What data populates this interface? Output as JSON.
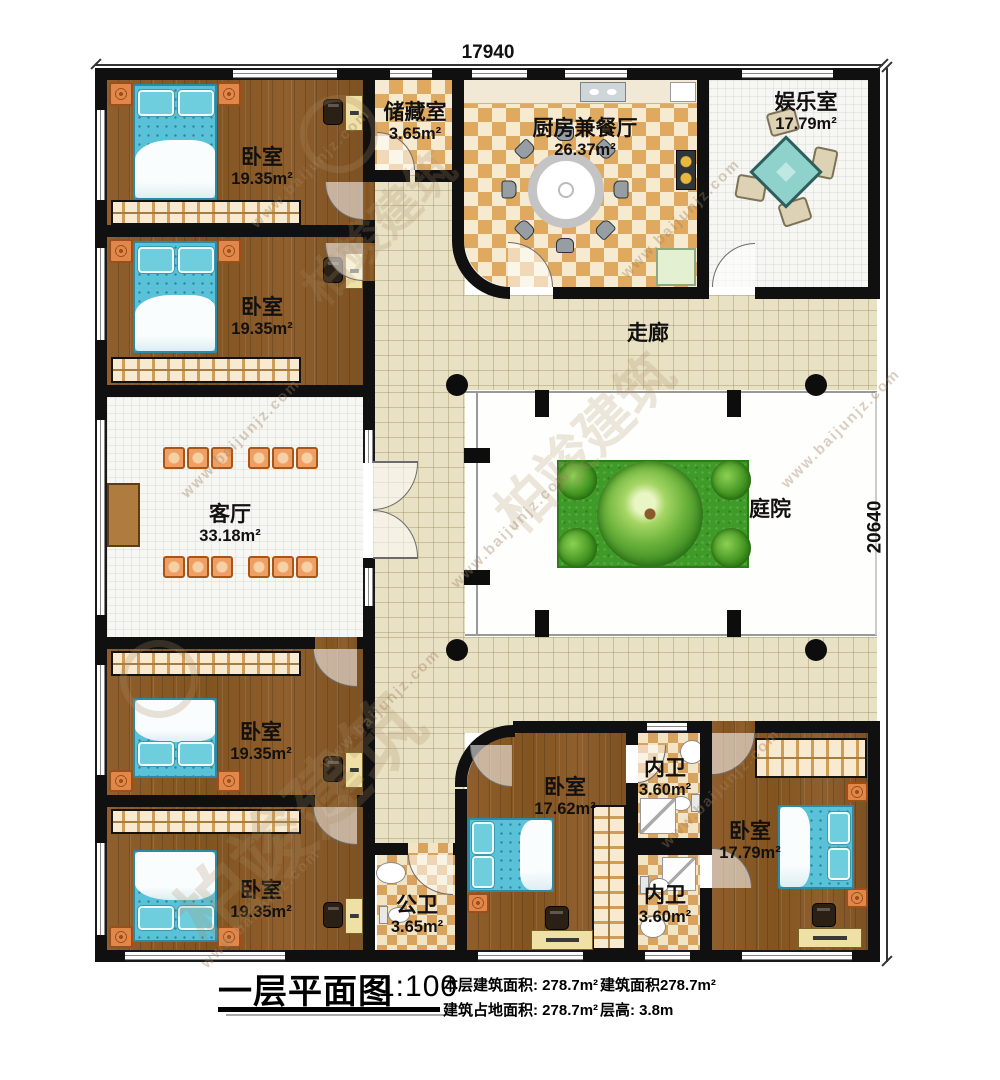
{
  "drawing": {
    "dimensions": {
      "top": "17940",
      "right": "20640"
    },
    "rooms": [
      {
        "name": "卧室",
        "area": "19.35m²"
      },
      {
        "name": "储藏室",
        "area": "3.65m²"
      },
      {
        "name": "厨房兼餐厅",
        "area": "26.37m²"
      },
      {
        "name": "娱乐室",
        "area": "17.79m²"
      },
      {
        "name": "卧室",
        "area": "19.35m²"
      },
      {
        "name": "走廊",
        "area": ""
      },
      {
        "name": "客厅",
        "area": "33.18m²"
      },
      {
        "name": "庭院",
        "area": ""
      },
      {
        "name": "卧室",
        "area": "19.35m²"
      },
      {
        "name": "卧室",
        "area": "19.35m²"
      },
      {
        "name": "公卫",
        "area": "3.65m²"
      },
      {
        "name": "卧室",
        "area": "17.62m²"
      },
      {
        "name": "内卫",
        "area": "3.60m²"
      },
      {
        "name": "内卫",
        "area": "3.60m²"
      },
      {
        "name": "卧室",
        "area": "17.79m²"
      }
    ],
    "title_block": {
      "title": "一层平面图",
      "scale": "1:100",
      "info_rows": [
        [
          "本层建筑面积: 278.7m²",
          "建筑面积278.7m²"
        ],
        [
          "建筑占地面积: 278.7m²",
          "层高: 3.8m"
        ]
      ]
    },
    "watermark": {
      "brand": "柏竣建筑",
      "url": "www.baijunjz.com"
    },
    "colors": {
      "wall": "#101010",
      "wood": "#8a5a2a",
      "checker_tan": "#dfa95f",
      "checker_cream": "#f6ead0",
      "corridor_tile": "#e9e1c4",
      "mattress": "#5ac2d8",
      "accent_orange": "#e2874a",
      "lawn": "#3f9b28",
      "mahjong_table": "#8fd2cc"
    }
  }
}
